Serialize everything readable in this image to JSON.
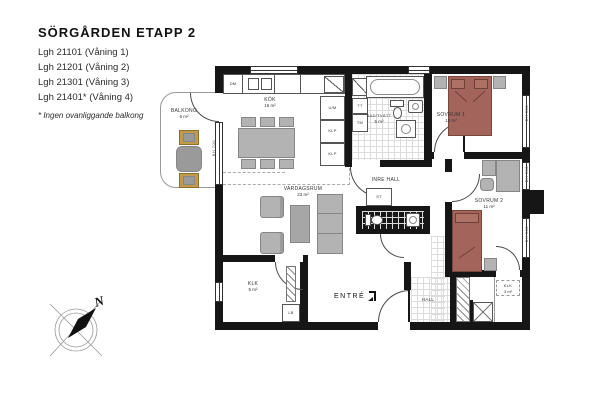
{
  "header": {
    "title": "SÖRGÅRDEN ETAPP 2",
    "apartments": [
      "Lgh 21101 (Våning 1)",
      "Lgh 21201 (Våning 2)",
      "Lgh 21301 (Våning 3)",
      "Lgh 21401* (Våning 4)"
    ],
    "footnote": "* Ingen ovanliggande balkong"
  },
  "rooms": {
    "balkong": {
      "name": "BALKONG",
      "area": "6 m²"
    },
    "kok": {
      "name": "KÖK",
      "area": "16 m²"
    },
    "bad": {
      "name": "BAD/TVÄTT",
      "area": "5 m²"
    },
    "sovrum1": {
      "name": "SOVRUM 1",
      "area": "12 m²"
    },
    "sovrum2": {
      "name": "SOVRUM 2",
      "area": "11 m²"
    },
    "vardagsrum": {
      "name": "VARDAGSRUM",
      "area": "23 m²"
    },
    "inre_hall": {
      "name": "INRE HALL"
    },
    "wc": {
      "name": "WC",
      "area": "3 m²"
    },
    "klk_stor": {
      "name": "KLK",
      "area": "5 m²"
    },
    "klk_liten": {
      "name": "KLK",
      "area": "3 m²"
    },
    "hall": {
      "name": "HALL"
    },
    "entre": {
      "name": "ENTRÉ"
    }
  },
  "fixtures": {
    "dishwasher": "DM",
    "oven_micro": "U/M",
    "wardrobe": "KLP",
    "dryer": "TT",
    "washer": "TM",
    "cleaning": "ST",
    "lb": "LB"
  },
  "dimensions": {
    "balcony_door": "BH 700",
    "window_sovrum1": "BH 500",
    "window_desk": "BH 500",
    "window_sovrum2": "BH 500"
  },
  "compass": {
    "north_label": "N"
  },
  "colors": {
    "wall": "#161616",
    "bed": "#a3655b",
    "furniture": "#b3b3b3",
    "balcony_chair": "#c09a4e"
  }
}
